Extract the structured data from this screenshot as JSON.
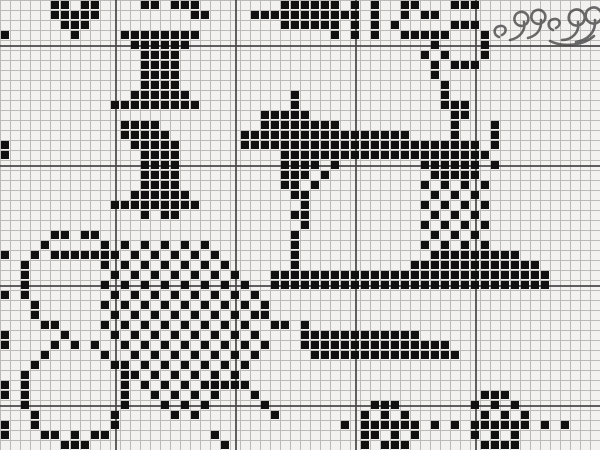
{
  "chart_title": "cross-stitch sewing sampler pattern",
  "colors": {
    "paper": "#f3f2f0",
    "grid_minor": "#bcbab7",
    "grid_major": "#454545",
    "stitch": "#101010",
    "flourish": "#484848"
  },
  "grid": {
    "cols": 60,
    "rows": 45,
    "cell_px": 10,
    "stitch_symbol": "#",
    "empty_symbol": ".",
    "rows_data": [
      ".....##.##....##.###........######.#.#..##...###............",
      ".....#####.........##....###########.#..#.##................",
      "......###...................######.#.#.#.....###............",
      "#......#....########.............#.#.#..#####...#...........",
      ".............######........................#....#...........",
      "..............####........................#.#...#...........",
      "..............####.........................#.###............",
      "..............####.........................#................",
      "..............####..........................#...............",
      ".............######..........#..............#...............",
      "...........#########.........#..............###.............",
      "..........................#####..............##.............",
      "............####..........########...........#...#..........",
      "............#####.......#################....#...#..........",
      "#............#####......########################.#..........",
      "#.............####..........#####################...........",
      "..............####..........####.#........######.#..........",
      "..............####..........###.#..........#####............",
      "..............####..........##.#..........#.#.#.#...........",
      ".............######..........##............#.#.#............",
      "...........#########..........#...........#.#.#.#...........",
      "..............#.##...........##............#.#.#............",
      "..............................#...........#.#.#.#...........",
      ".....##.##...................#.............#.#.#............",
      "....#.....#.#.#.#.#.#........#............#.#.#.#...........",
      "#..#.#######.#.#.#.#.#.......#.............#########........",
      "..#.......#.#.#.#.#.#.#......#...........#############......",
      "..#........#.#.#.#.#.#.#...############################.....",
      "..#.......#.#.#.#.#.#.#.#..############################.....",
      "#.#........#.#.#.#.#.#.#.#..................................",
      "...#......#.#.#.#.#.#.#.#.#.................................",
      "...#.......#.#.#.#.#.#.#.##.................................",
      "....##....#.#.#.#.#.#.#.#..##.#.............................",
      "#.....#....#.#.#.#.#.#.#.#....############..................",
      "#....#.#.#..#.#.#.#.#.#.#.#...###############...............",
      "....#.....#..#.#.#.#.#.#.#.....###############..............",
      "...#.......##.#.#.#.#.#.#...................................",
      "..#.........##.#.#.#.#.#....................................",
      "#.#.........#.#.#.#.#####...................................",
      "#.#.........#..#.#.#.#...#......................###.........",
      "..#.........#...#.#.#.....#..........###.......#.#.#........",
      "...#.......#.....#.#.......#........#.#.#.......#.#.#.......",
      "#..#.......#......................#.######.#.#.######.#.#...",
      "#...##.#.##..........#..............##.#.#.....#.#.#........",
      "......###.............#.............#.###.......####........"
    ]
  },
  "grid_major_lines": {
    "vertical_x": [
      115,
      235,
      355,
      475
    ],
    "horizontal_y": [
      45,
      165,
      285,
      405
    ]
  },
  "motifs": [
    {
      "name": "mini-heart-motif",
      "x": 50,
      "y": 0,
      "w": 50,
      "h": 40
    },
    {
      "name": "thread-spool-upper",
      "x": 110,
      "y": 30,
      "w": 90,
      "h": 80
    },
    {
      "name": "thread-spool-lower",
      "x": 110,
      "y": 120,
      "w": 90,
      "h": 100
    },
    {
      "name": "dark-motif-top-cropped",
      "x": 250,
      "y": 0,
      "w": 110,
      "h": 50
    },
    {
      "name": "thread-ring-motif",
      "x": 430,
      "y": 0,
      "w": 60,
      "h": 70
    },
    {
      "name": "sewing-machine-motif",
      "x": 240,
      "y": 90,
      "w": 310,
      "h": 200
    },
    {
      "name": "scissors-motif",
      "x": 0,
      "y": 230,
      "w": 130,
      "h": 220
    },
    {
      "name": "thread-tangle-motif",
      "x": 90,
      "y": 240,
      "w": 200,
      "h": 180
    },
    {
      "name": "needle-motif",
      "x": 300,
      "y": 320,
      "w": 170,
      "h": 50
    },
    {
      "name": "button-left-motif",
      "x": 360,
      "y": 400,
      "w": 60,
      "h": 50
    },
    {
      "name": "button-right-motif",
      "x": 470,
      "y": 390,
      "w": 60,
      "h": 60
    },
    {
      "name": "dashed-thread-line",
      "x": 340,
      "y": 420,
      "w": 230,
      "h": 10
    }
  ],
  "decoration": {
    "name": "script-flourish",
    "note": "cursive pen flourish, cropped at top-right corner"
  }
}
